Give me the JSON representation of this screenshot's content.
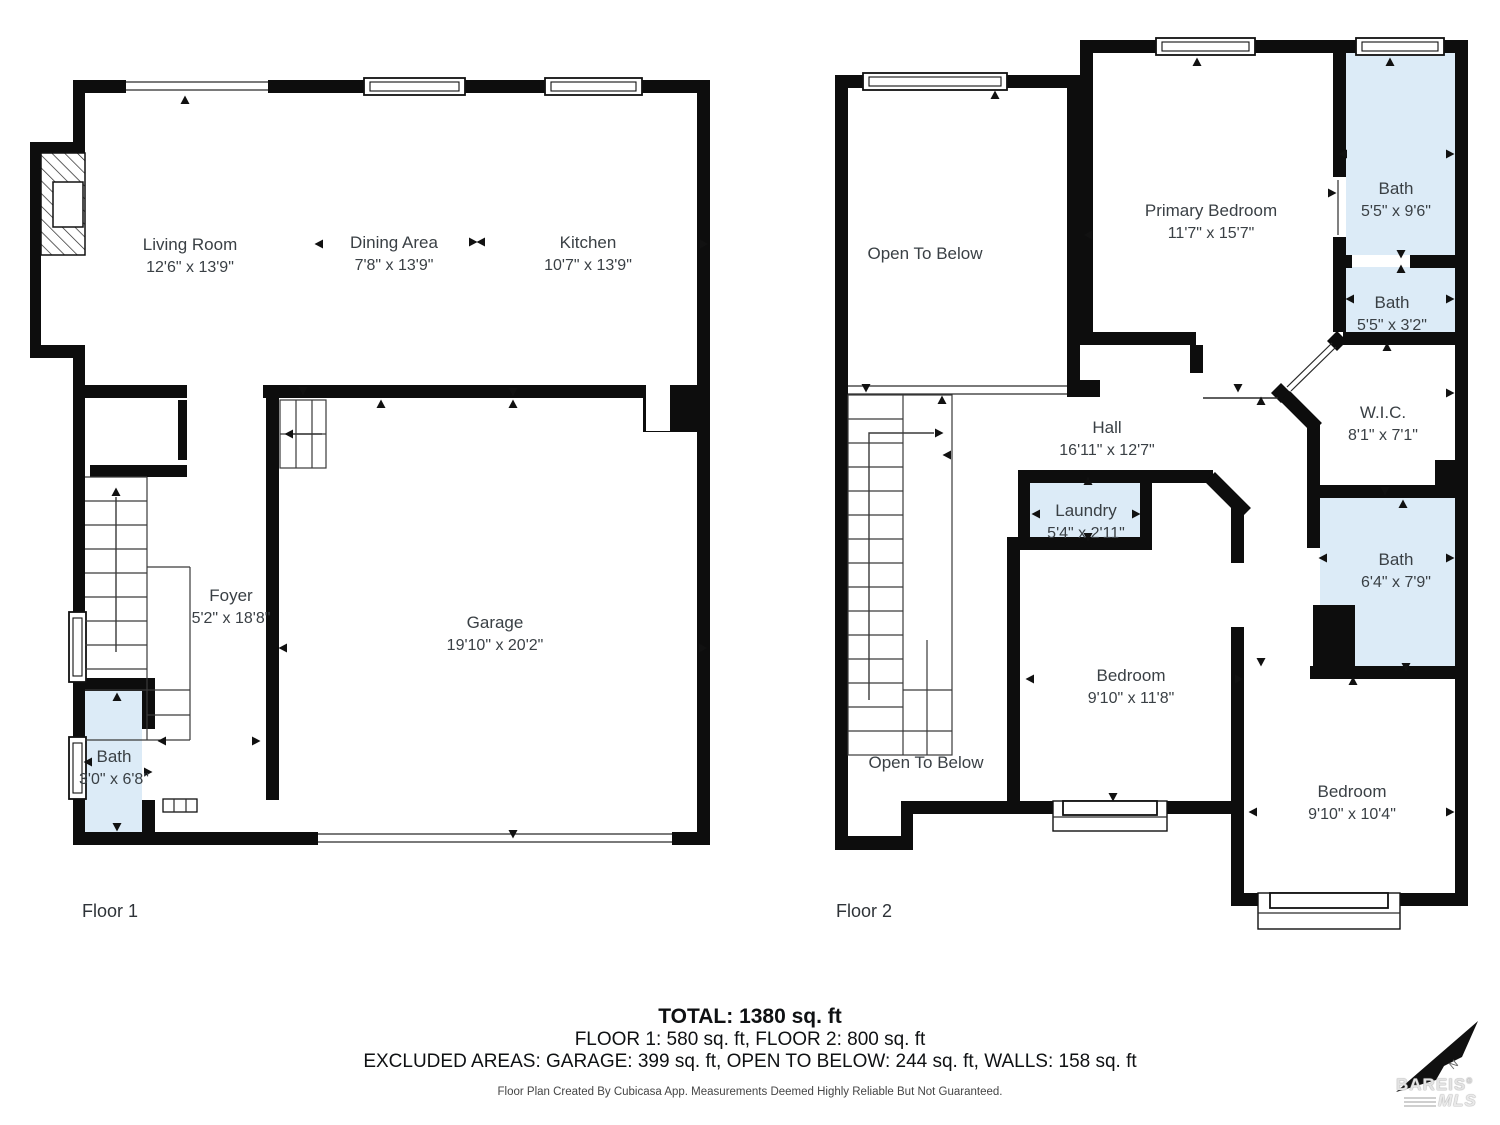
{
  "floor1": {
    "label": "Floor 1",
    "rooms": {
      "living_room": {
        "name": "Living Room",
        "dims": "12'6\" x 13'9\""
      },
      "dining_area": {
        "name": "Dining Area",
        "dims": "7'8\" x 13'9\""
      },
      "kitchen": {
        "name": "Kitchen",
        "dims": "10'7\" x 13'9\""
      },
      "foyer": {
        "name": "Foyer",
        "dims": "5'2\" x 18'8\""
      },
      "garage": {
        "name": "Garage",
        "dims": "19'10\" x 20'2\""
      },
      "bath": {
        "name": "Bath",
        "dims": "3'0\" x 6'8\""
      }
    }
  },
  "floor2": {
    "label": "Floor 2",
    "rooms": {
      "open_to_below_top": {
        "name": "Open To Below"
      },
      "primary_bedroom": {
        "name": "Primary Bedroom",
        "dims": "11'7\" x 15'7\""
      },
      "bath_ensuite": {
        "name": "Bath",
        "dims": "5'5\" x 9'6\""
      },
      "bath_small": {
        "name": "Bath",
        "dims": "5'5\" x 3'2\""
      },
      "hall": {
        "name": "Hall",
        "dims": "16'11\" x 12'7\""
      },
      "wic": {
        "name": "W.I.C.",
        "dims": "8'1\" x 7'1\""
      },
      "laundry": {
        "name": "Laundry",
        "dims": "5'4\" x 2'11\""
      },
      "bath_hall": {
        "name": "Bath",
        "dims": "6'4\" x 7'9\""
      },
      "bedroom_mid": {
        "name": "Bedroom",
        "dims": "9'10\" x 11'8\""
      },
      "bedroom_corner": {
        "name": "Bedroom",
        "dims": "9'10\" x 10'4\""
      },
      "open_to_below_bottom": {
        "name": "Open To Below"
      }
    }
  },
  "summary": {
    "total": "TOTAL: 1380 sq. ft",
    "floors": "FLOOR 1: 580 sq. ft, FLOOR 2: 800 sq. ft",
    "excluded": "EXCLUDED AREAS: GARAGE: 399 sq. ft, OPEN TO BELOW: 244 sq. ft, WALLS: 158 sq. ft",
    "disclaimer": "Floor Plan Created By Cubicasa App. Measurements Deemed Highly Reliable But Not Guaranteed."
  },
  "logo": {
    "line1": "BAREIS",
    "registered": "®",
    "line2": "MLS",
    "compass": "N"
  },
  "colors": {
    "wall": "#0d0d0d",
    "wet_room_fill": "#dcebf7",
    "label_text": "#3a4045"
  }
}
